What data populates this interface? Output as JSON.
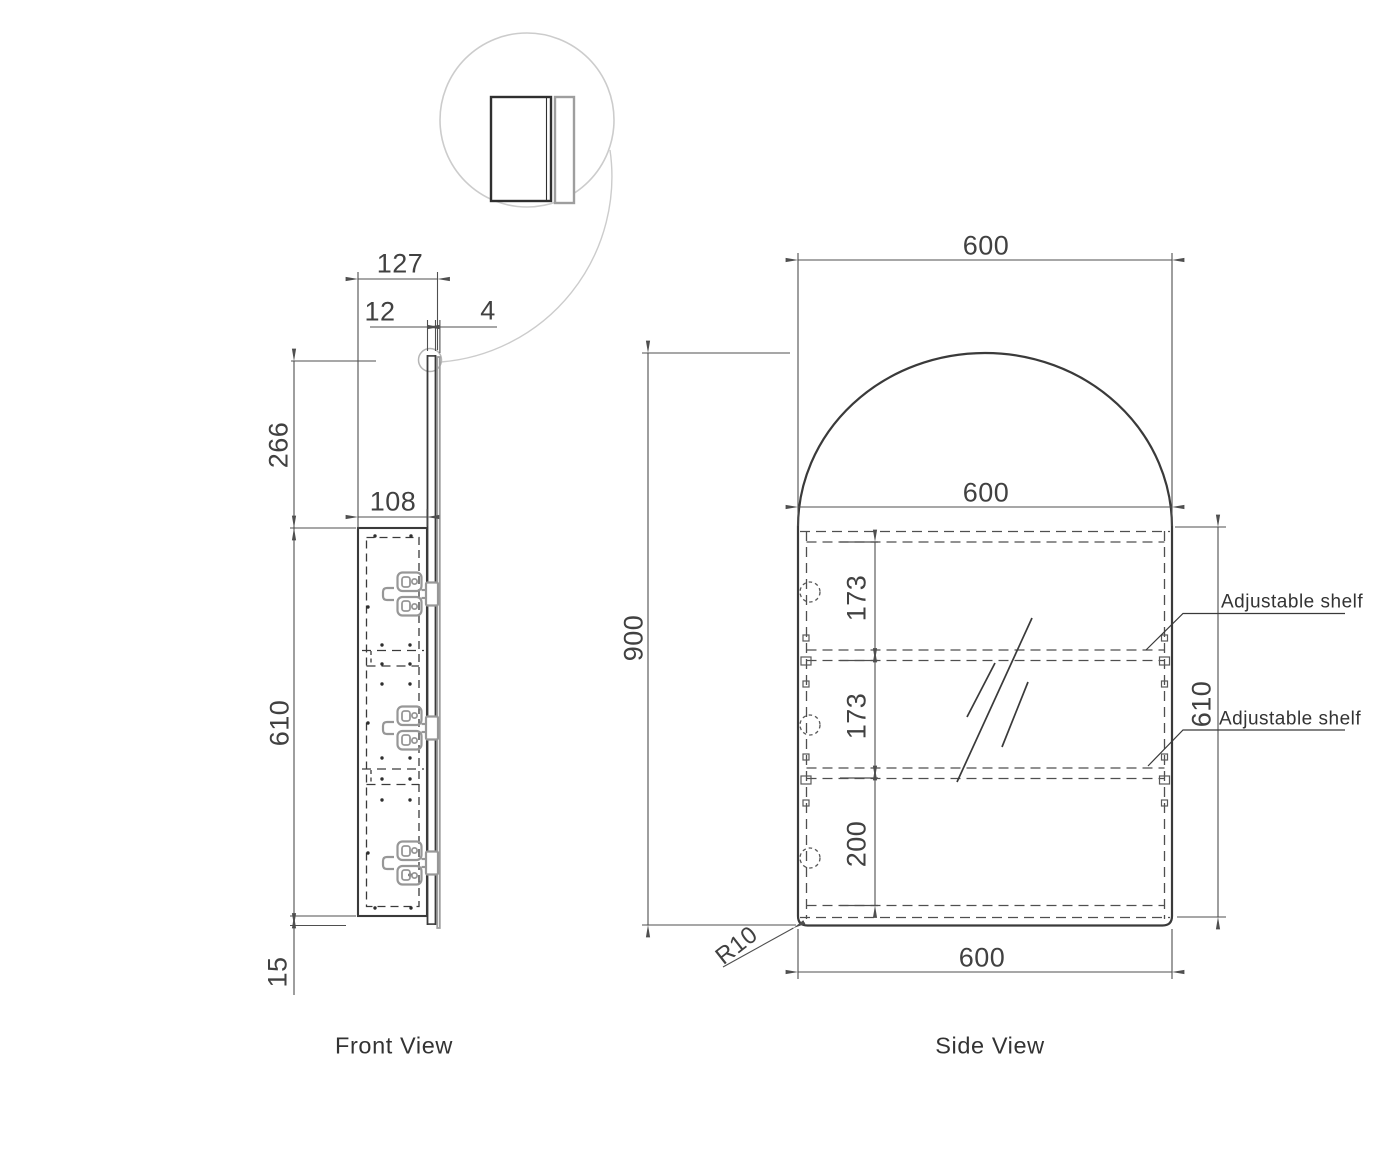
{
  "drawing": {
    "front_view": {
      "title": "Front View",
      "dimensions": {
        "overall_depth": "127",
        "door_thickness": "12",
        "mirror_thickness": "4",
        "top_offset": "266",
        "body_depth": "108",
        "body_height": "610",
        "bottom_overhang": "15"
      }
    },
    "side_view": {
      "title": "Side View",
      "dimensions": {
        "top_width": "600",
        "inner_width": "600",
        "overall_height": "900",
        "shelf_space_top": "173",
        "shelf_space_middle": "173",
        "shelf_space_bottom": "200",
        "cabinet_height": "610",
        "bottom_width": "600",
        "corner_radius": "R10"
      },
      "labels": {
        "adjustable_shelf_1": "Adjustable shelf",
        "adjustable_shelf_2": "Adjustable shelf"
      }
    },
    "colors": {
      "line": "#3a3a3a",
      "dim_line": "#4f4f4f",
      "light_gray": "#9e9e9e",
      "bubble": "#cccccc"
    }
  }
}
